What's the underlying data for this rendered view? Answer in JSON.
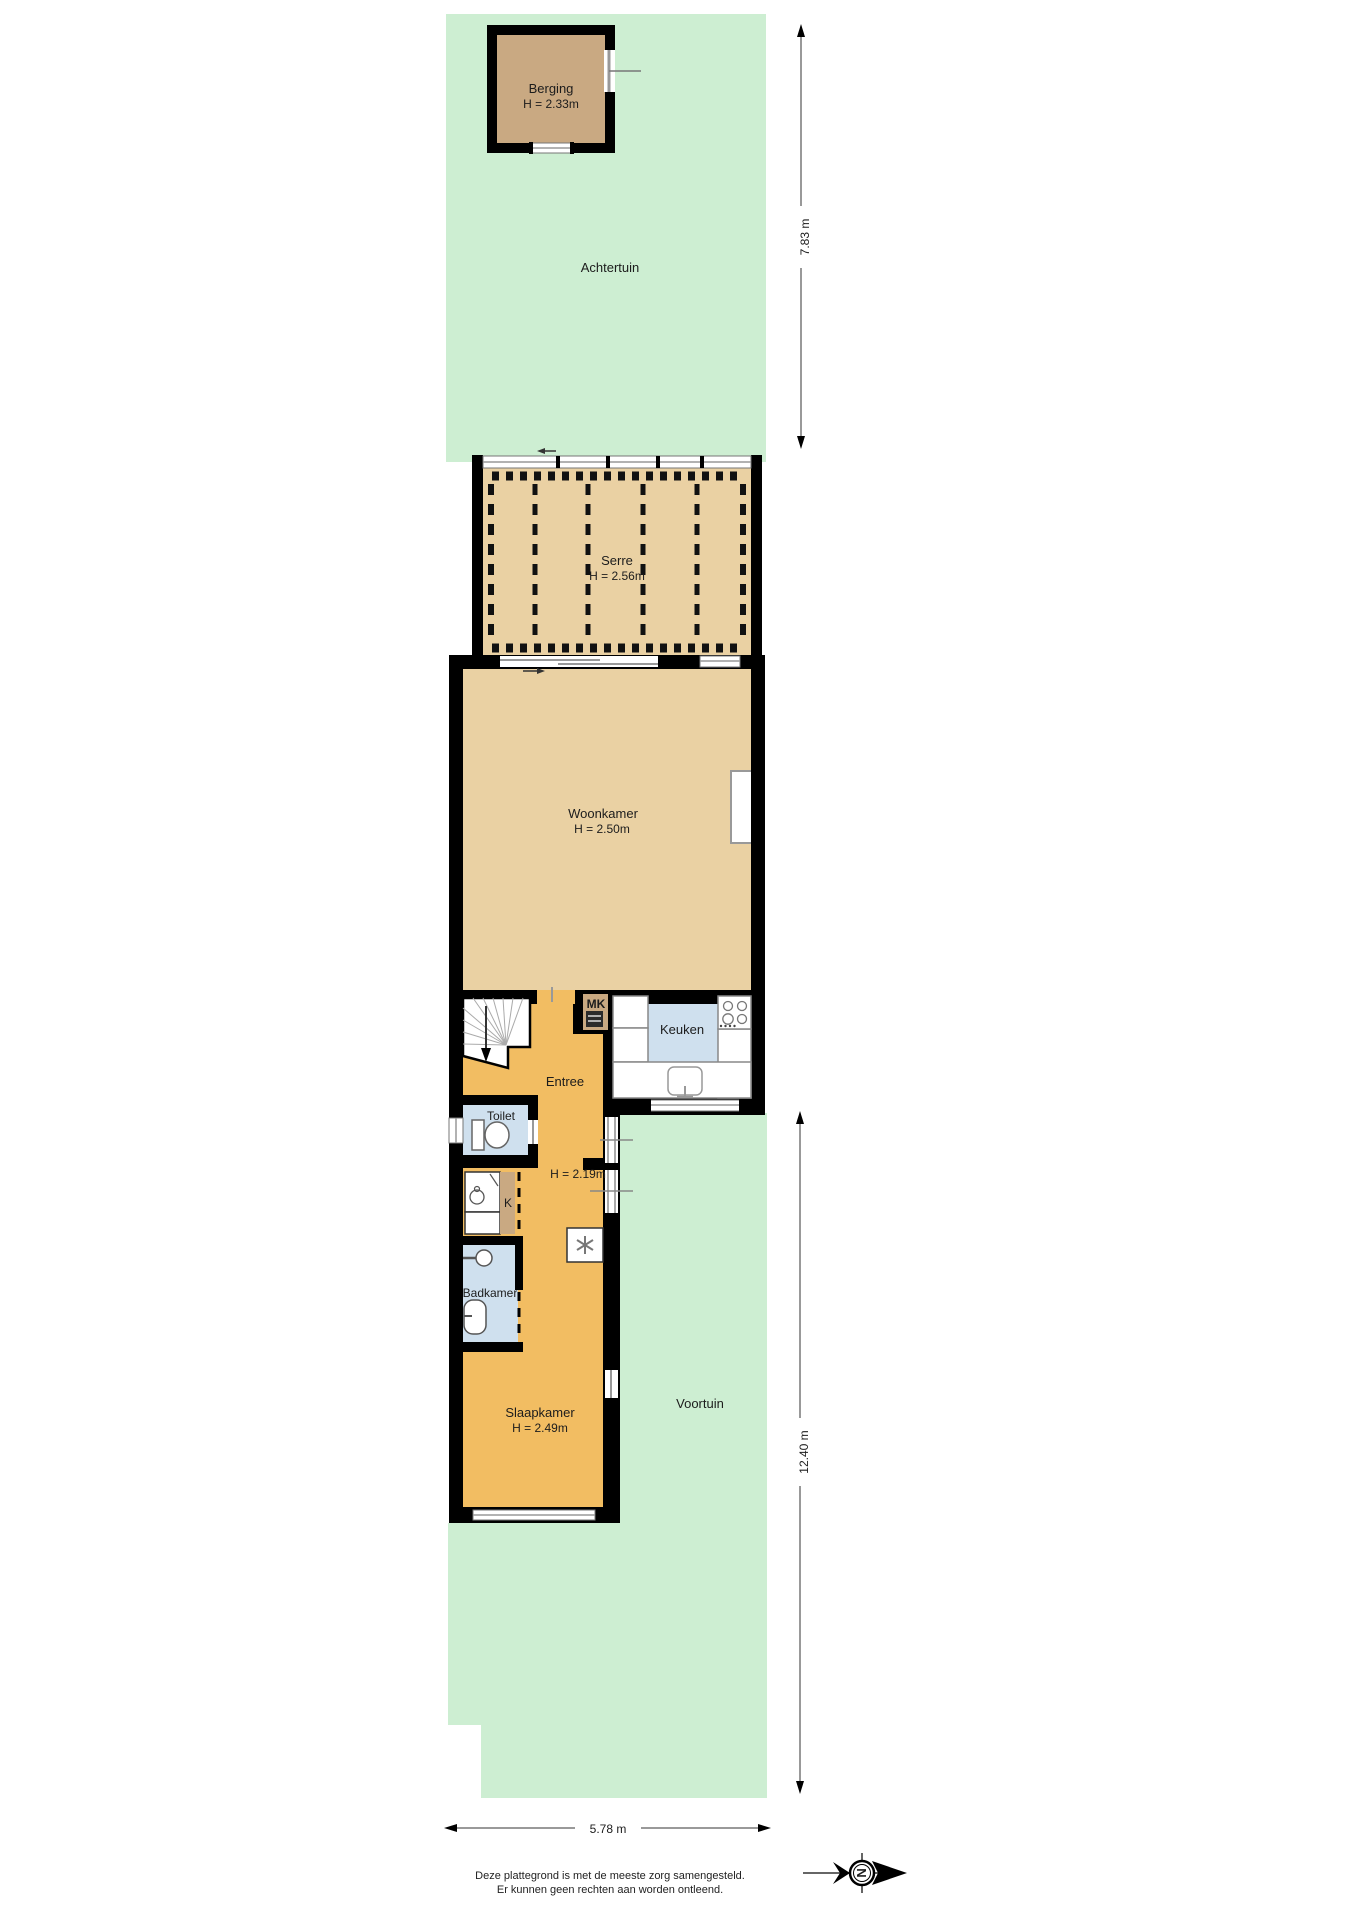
{
  "rooms": {
    "berging": {
      "name": "Berging",
      "height": "H = 2.33m"
    },
    "achtertuin": {
      "name": "Achtertuin"
    },
    "serre": {
      "name": "Serre",
      "height": "H = 2.56m"
    },
    "woonkamer": {
      "name": "Woonkamer",
      "height": "H = 2.50m"
    },
    "keuken": {
      "name": "Keuken"
    },
    "meterkast": {
      "name": "MK"
    },
    "entree": {
      "name": "Entree"
    },
    "toilet": {
      "name": "Toilet"
    },
    "hal": {
      "height": "H = 2.19m"
    },
    "kast": {
      "name": "K"
    },
    "badkamer": {
      "name": "Badkamer"
    },
    "slaapkamer": {
      "name": "Slaapkamer",
      "height": "H = 2.49m"
    },
    "voortuin": {
      "name": "Voortuin"
    }
  },
  "measurements": {
    "back_garden_depth": "7.83 m",
    "front_garden_depth": "12.40 m",
    "plot_width": "5.78 m"
  },
  "disclaimer": {
    "line1": "Deze plattegrond is met de meeste zorg samengesteld.",
    "line2": "Er kunnen geen rechten aan worden ontleend."
  },
  "compass": {
    "letter": "N"
  },
  "colors": {
    "garden_green": "#cdeed2",
    "floor_tan": "#ead1a3",
    "floor_dark_tan": "#c9a982",
    "floor_orange": "#f2bd62",
    "floor_blue": "#cfe0ee",
    "wall_black": "#000000"
  }
}
